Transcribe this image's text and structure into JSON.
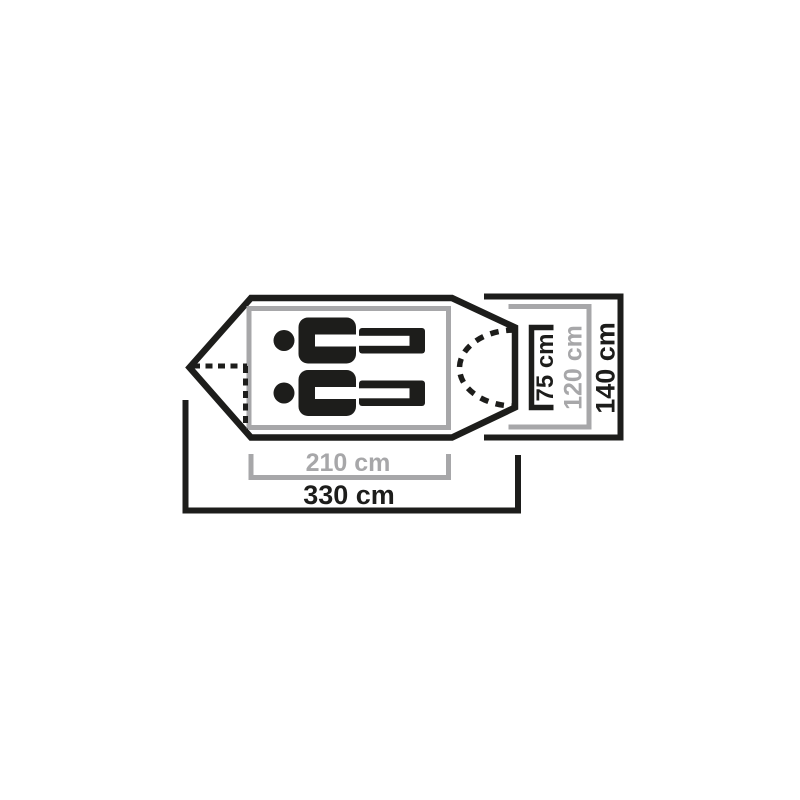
{
  "page": {
    "background": "#ffffff"
  },
  "diagram": {
    "name": "tent-floorplan-top-view",
    "occupant_count": 2,
    "colors": {
      "primary_outline": "#1d1d1b",
      "secondary_outline": "#a7a7a9",
      "background": "#ffffff"
    },
    "labels": {
      "inner_length": "210 cm",
      "total_length": "330 cm",
      "entrance_width": "75 cm",
      "inner_width": "120 cm",
      "total_width": "140 cm"
    }
  }
}
